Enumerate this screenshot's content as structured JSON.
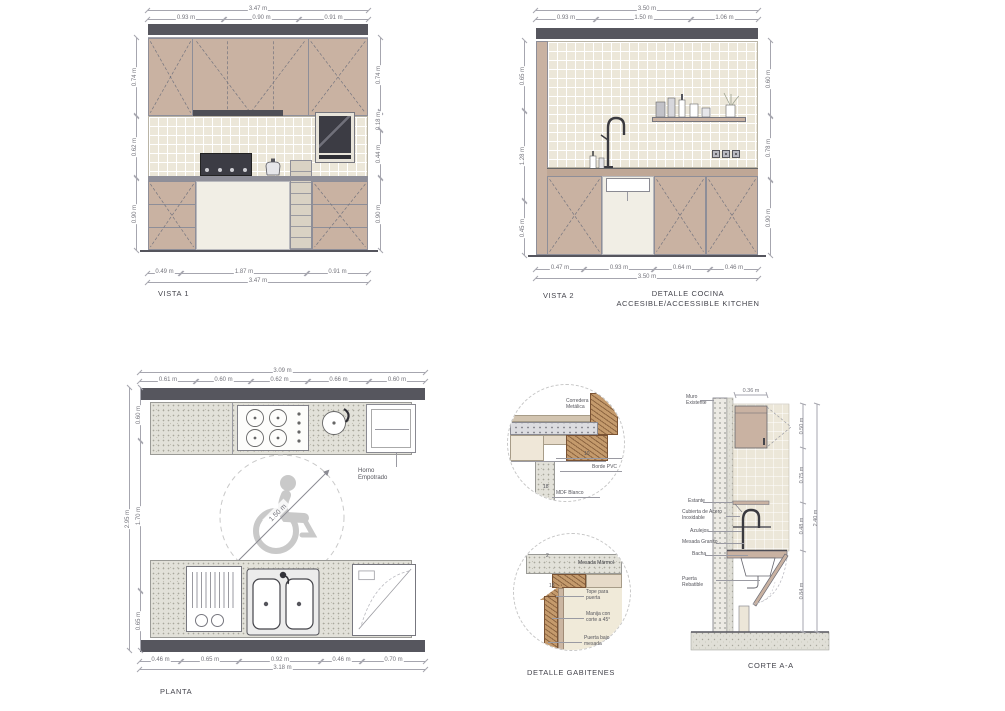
{
  "colors": {
    "cabinet": "#c9b2a2",
    "soffit": "#56565e",
    "tile": "#ece7d9",
    "wood": "#c49a6c",
    "dim_text": "#74747c",
    "wheelchair": "#c9c9c9"
  },
  "vista1": {
    "title": "VISTA 1",
    "dim_top_total": "3.47 m",
    "dim_top_segments": [
      "0.93 m",
      "0.90 m",
      "0.91 m"
    ],
    "dim_bottom_segments": [
      "0.49 m",
      "1.87 m",
      "0.91 m"
    ],
    "dim_bottom_total": "3.47 m",
    "dim_left": [
      "0.74 m",
      "0.62 m",
      "0.90 m"
    ],
    "dim_right": [
      "0.74 m",
      "0.18 m",
      "0.44 m",
      "0.90 m"
    ]
  },
  "vista2": {
    "title": "VISTA 2",
    "subtitle1": "DETALLE COCINA",
    "subtitle2": "ACCESIBLE/ACCESSIBLE KITCHEN",
    "dim_top_total": "3.50 m",
    "dim_top_segments": [
      "0.93 m",
      "1.50 m",
      "1.06 m"
    ],
    "dim_bottom_segments": [
      "0.47 m",
      "0.93 m",
      "0.64 m",
      "0.46 m"
    ],
    "dim_bottom_total": "3.50 m",
    "dim_left": [
      "0.65 m",
      "1.28 m",
      "0.45 m"
    ],
    "dim_right": [
      "0.60 m",
      "0.78 m",
      "0.90 m"
    ]
  },
  "planta": {
    "title": "PLANTA",
    "dim_top_total": "3.09 m",
    "dim_top_segments": [
      "0.61 m",
      "0.60 m",
      "0.62 m",
      "0.66 m",
      "0.60 m"
    ],
    "dim_bottom_segments": [
      "0.46 m",
      "0.65 m",
      "0.92 m",
      "0.46 m",
      "0.70 m"
    ],
    "dim_bottom_total": "3.18 m",
    "dim_left": [
      "0.60 m",
      "1.70 m",
      "0.65 m"
    ],
    "dim_left_total": "2.95 m",
    "turning_radius": "1.50 m",
    "oven_label": "Horno Empotrado"
  },
  "detalle": {
    "title": "DETALLE GABITENES",
    "corredera": "Corredera Metálica",
    "borde": "Borde PVC",
    "mdf": "MDF Blanco",
    "dim10": "10",
    "dim18": "18",
    "mesada": "Mesada Mármol",
    "tope": "Tope para puerta",
    "manija": "Manija con corte a 45°",
    "puerta": "Puerta bajo mesada",
    "dim2": "2",
    "dim18b": "18"
  },
  "corte": {
    "title": "CORTE A-A",
    "dim_top": "0.36 m",
    "muro": "Muro Existente",
    "estante": "Estante",
    "cubierta": "Cubierta de Acero Inoxidable",
    "azulejos": "Azulejos",
    "mesada": "Mesada Granito",
    "bacha": "Bacha",
    "puerta": "Puerta Rebatible",
    "dim_right": [
      "0.50 m",
      "0.75 m",
      "0.48 m",
      "0.84 m"
    ],
    "dim_right_total": "2.40 m"
  }
}
